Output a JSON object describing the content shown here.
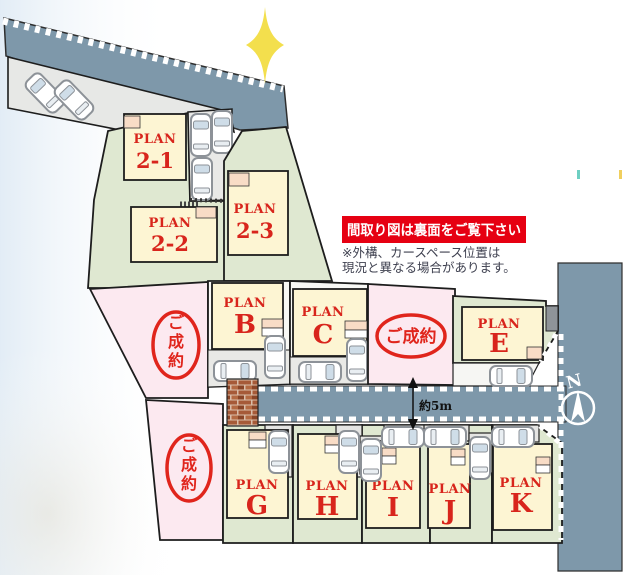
{
  "banner": {
    "text": "間取り図は裏面をご覧下さい"
  },
  "note": {
    "line1": "※外構、カースペース位置は",
    "line2": "現況と異なる場合があります。"
  },
  "road": {
    "width_label": "約5m"
  },
  "compass": {
    "north_label": "N"
  },
  "sold_stamps": [
    {
      "text": "ご成約",
      "orientation": "vertical",
      "chars": [
        "ご",
        "成",
        "約"
      ]
    },
    {
      "text": "ご成約",
      "orientation": "horizontal",
      "chars": [
        "ご",
        "成",
        "約"
      ]
    },
    {
      "text": "ご成約",
      "orientation": "vertical",
      "chars": [
        "ご",
        "成",
        "約"
      ]
    }
  ],
  "plans": [
    {
      "label": "PLAN",
      "id": "2-1"
    },
    {
      "label": "PLAN",
      "id": "2-2"
    },
    {
      "label": "PLAN",
      "id": "2-3"
    },
    {
      "label": "PLAN",
      "id": "B"
    },
    {
      "label": "PLAN",
      "id": "C"
    },
    {
      "label": "PLAN",
      "id": "E"
    },
    {
      "label": "PLAN",
      "id": "G"
    },
    {
      "label": "PLAN",
      "id": "H"
    },
    {
      "label": "PLAN",
      "id": "I"
    },
    {
      "label": "PLAN",
      "id": "J"
    },
    {
      "label": "PLAN",
      "id": "K"
    }
  ],
  "colors": {
    "road": "#7e98aa",
    "lot_green": "#dfe8d1",
    "lot_pink": "#fce9f0",
    "lot_white": "#f8f8f5",
    "building": "#fdf5d3",
    "plan_text_red": "#d8251c",
    "stamp_red": "#e0251c",
    "banner_red": "#e60012",
    "brick": "#a65a38",
    "star_yellow": "#f3df4d",
    "driveway_gray": "#e9e9e6"
  }
}
